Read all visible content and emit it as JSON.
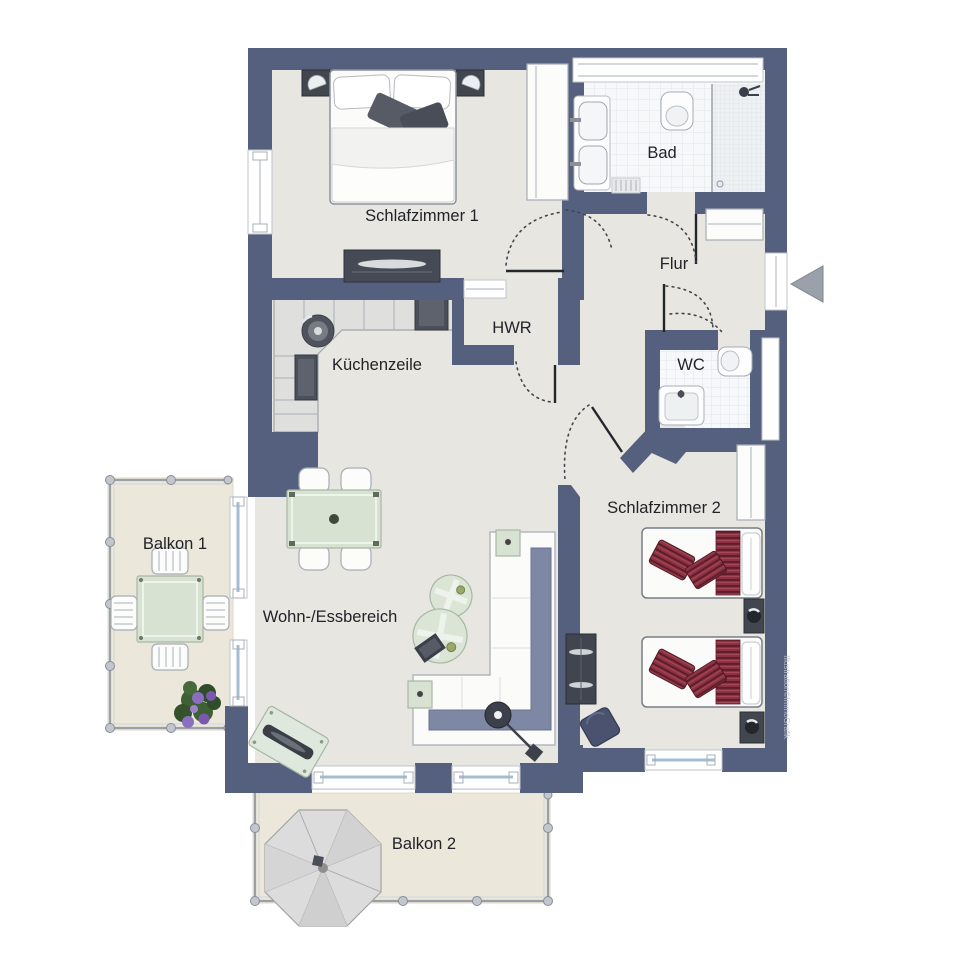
{
  "rooms": {
    "schlafzimmer1": "Schlafzimmer 1",
    "bad": "Bad",
    "flur": "Flur",
    "hwr": "HWR",
    "kuechenzeile": "Küchenzeile",
    "wc": "WC",
    "schlafzimmer2": "Schlafzimmer 2",
    "wohnEssbereich": "Wohn-/Essbereich",
    "balkon1": "Balkon 1",
    "balkon2": "Balkon 2"
  },
  "watermark": "Illustration©ImmoGrafik",
  "colors": {
    "wall": "#555f7e",
    "floor": "#e8e6e1",
    "balcony": "#ebe7da",
    "tile": "#f7f8fa",
    "green": "#d7e2d2",
    "red": "#8c3142",
    "sofa": "#7e88a4",
    "dark": "#42464f",
    "outline": "#a7adb5"
  }
}
